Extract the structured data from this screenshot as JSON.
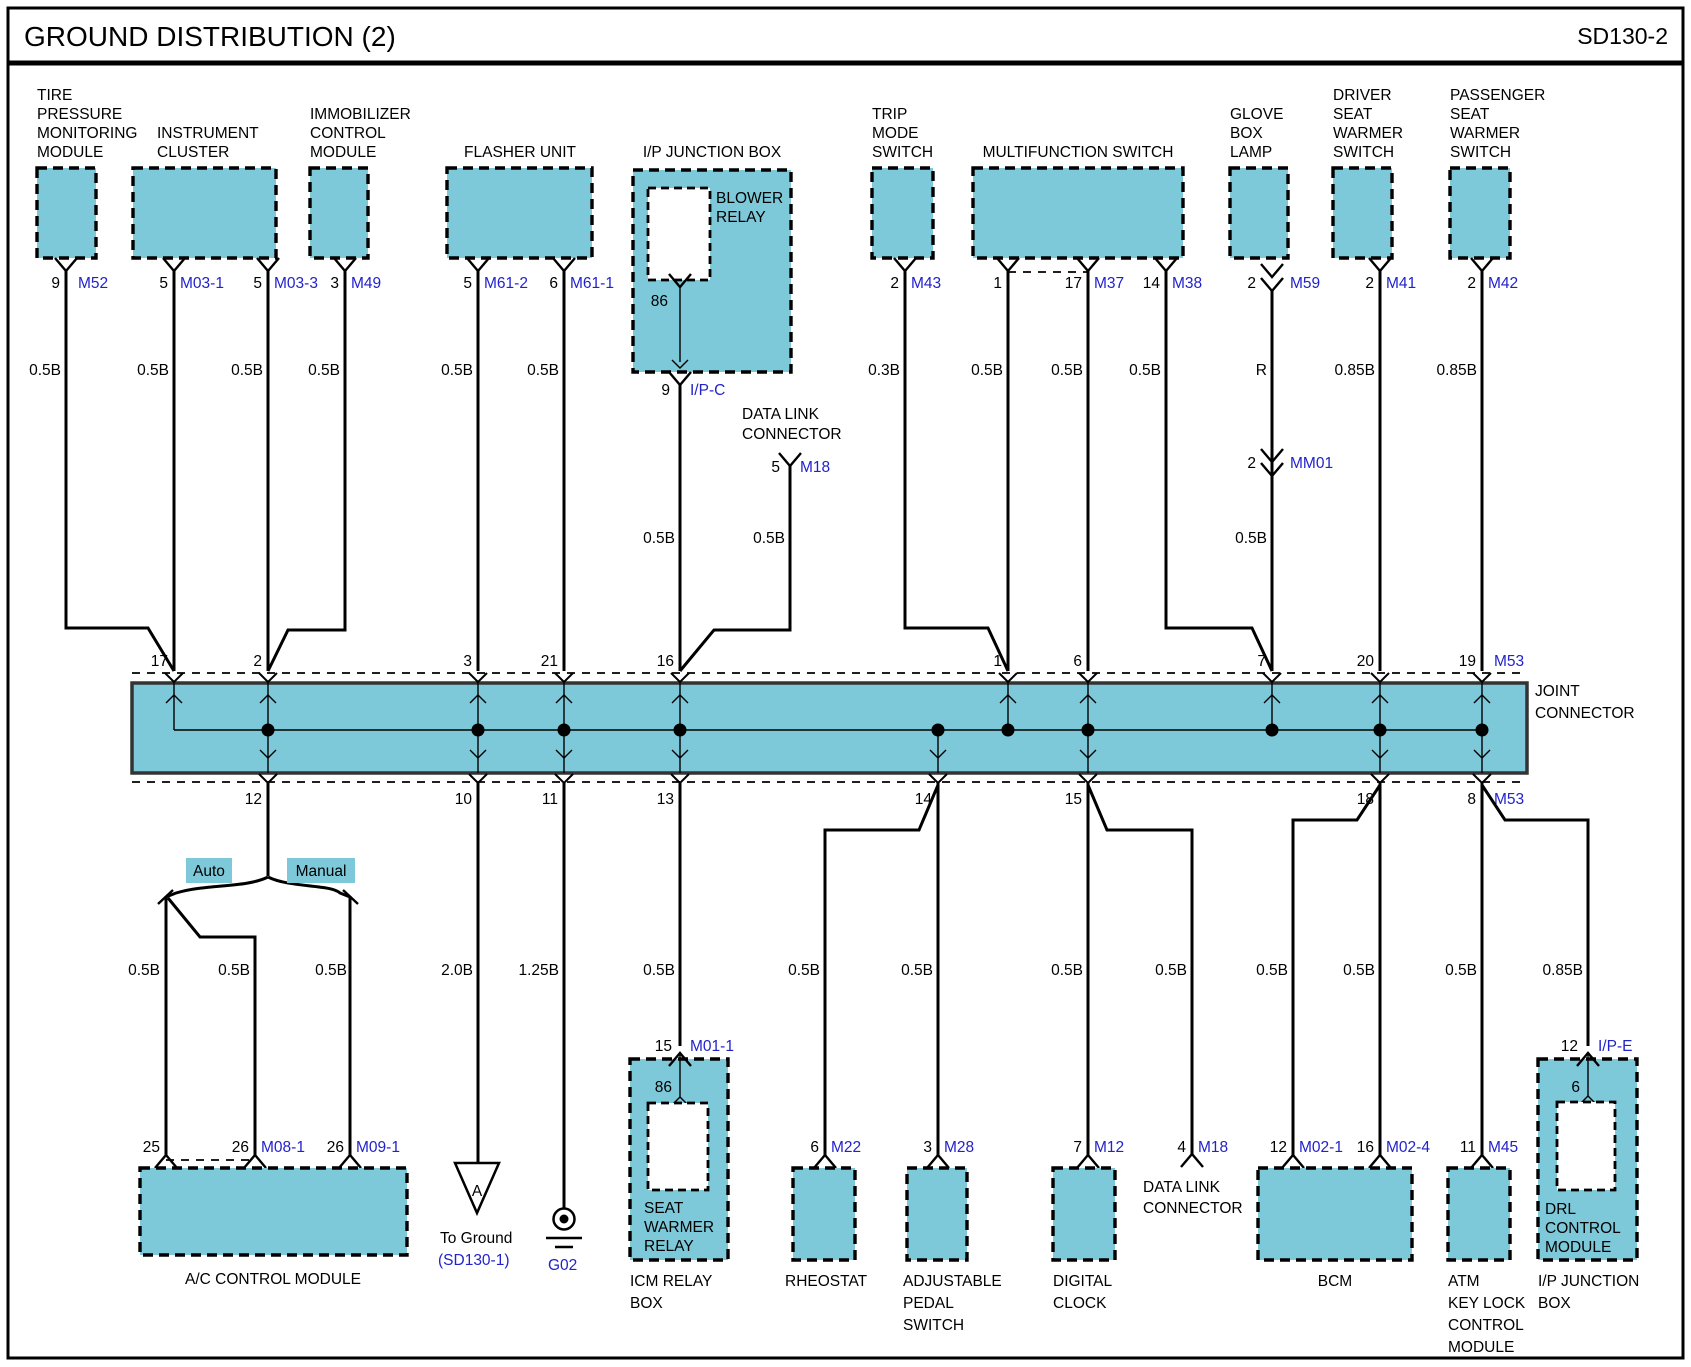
{
  "header": {
    "title": "GROUND DISTRIBUTION (2)",
    "code": "SD130-2"
  },
  "colors": {
    "module_fill": "#7ec9d9",
    "connector_text": "#2222cc",
    "wire": "#000000"
  },
  "top_row": {
    "tpms": {
      "name": [
        "TIRE",
        "PRESSURE",
        "MONITORING",
        "MODULE"
      ],
      "pin": "9",
      "connector": "M52",
      "wire": "0.5B"
    },
    "cluster": {
      "name": [
        "INSTRUMENT",
        "CLUSTER"
      ],
      "pins": [
        "5",
        "5"
      ],
      "connectors": [
        "M03-1",
        "M03-3"
      ],
      "wires": [
        "0.5B",
        "0.5B"
      ]
    },
    "immobilizer": {
      "name": [
        "IMMOBILIZER",
        "CONTROL",
        "MODULE"
      ],
      "pin": "3",
      "connector": "M49",
      "wire": "0.5B"
    },
    "flasher": {
      "name": "FLASHER UNIT",
      "pins": [
        "5",
        "6"
      ],
      "connectors": [
        "M61-2",
        "M61-1"
      ],
      "wires": [
        "0.5B",
        "0.5B"
      ]
    },
    "ip_junction": {
      "name": "I/P JUNCTION BOX",
      "relay": [
        "BLOWER",
        "RELAY"
      ],
      "relay_pin": "86",
      "pin": "9",
      "connector": "I/P-C",
      "wire": "0.5B"
    },
    "data_link": {
      "name": [
        "DATA LINK",
        "CONNECTOR"
      ],
      "pin": "5",
      "connector": "M18",
      "wire": "0.5B"
    },
    "trip": {
      "name": [
        "TRIP",
        "MODE",
        "SWITCH"
      ],
      "pin": "2",
      "connector": "M43",
      "wire": "0.3B"
    },
    "multifunction": {
      "name": "MULTIFUNCTION SWITCH",
      "pins": [
        "1",
        "17",
        "14"
      ],
      "connectors": [
        "M37",
        "M38"
      ],
      "wires": [
        "0.5B",
        "0.5B",
        "0.5B"
      ]
    },
    "glove": {
      "name": [
        "GLOVE",
        "BOX",
        "LAMP"
      ],
      "pin": "2",
      "connector": "M59",
      "wire1": "R",
      "pin2": "2",
      "connector2": "MM01",
      "wire2": "0.5B"
    },
    "driver_sws": {
      "name": [
        "DRIVER",
        "SEAT",
        "WARMER",
        "SWITCH"
      ],
      "pin": "2",
      "connector": "M41",
      "wire": "0.85B"
    },
    "passenger_sws": {
      "name": [
        "PASSENGER",
        "SEAT",
        "WARMER",
        "SWITCH"
      ],
      "pin": "2",
      "connector": "M42",
      "wire": "0.85B"
    }
  },
  "joint_connector": {
    "name": [
      "JOINT",
      "CONNECTOR"
    ],
    "top_pins": [
      "17",
      "2",
      "3",
      "21",
      "16",
      "1",
      "6",
      "7",
      "20",
      "19"
    ],
    "top_connector": "M53",
    "bottom_pins": [
      "12",
      "10",
      "11",
      "13",
      "14",
      "15",
      "18",
      "8"
    ],
    "bottom_connector": "M53"
  },
  "bottom_row": {
    "ac": {
      "name": "A/C CONTROL MODULE",
      "branch_auto": "Auto",
      "branch_manual": "Manual",
      "wires": [
        "0.5B",
        "0.5B",
        "0.5B"
      ],
      "pins": [
        "25",
        "26",
        "26"
      ],
      "connectors": [
        "M08-1",
        "M09-1"
      ]
    },
    "ground": {
      "wire": "2.0B",
      "symbol": "A",
      "text": "To Ground",
      "ref": "(SD130-1)"
    },
    "g02": {
      "wire": "1.25B",
      "name": "G02"
    },
    "icm": {
      "wire": "0.5B",
      "pin": "15",
      "connector": "M01-1",
      "relay_pin": "86",
      "relay": [
        "SEAT",
        "WARMER",
        "RELAY"
      ],
      "name": [
        "ICM RELAY",
        "BOX"
      ]
    },
    "rheostat": {
      "wire": "0.5B",
      "pin": "6",
      "connector": "M22",
      "name": "RHEOSTAT"
    },
    "pedal": {
      "wire": "0.5B",
      "pin": "3",
      "connector": "M28",
      "name": [
        "ADJUSTABLE",
        "PEDAL",
        "SWITCH"
      ]
    },
    "clock": {
      "wire": "0.5B",
      "pin": "7",
      "connector": "M12",
      "name": [
        "DIGITAL",
        "CLOCK"
      ]
    },
    "data_link": {
      "wire": "0.5B",
      "pin": "4",
      "connector": "M18",
      "name": [
        "DATA LINK",
        "CONNECTOR"
      ]
    },
    "bcm": {
      "wires": [
        "0.5B",
        "0.5B"
      ],
      "pins": [
        "12",
        "16"
      ],
      "connectors": [
        "M02-1",
        "M02-4"
      ],
      "name": "BCM"
    },
    "atm": {
      "wire": "0.5B",
      "pin": "11",
      "connector": "M45",
      "name": [
        "ATM",
        "KEY LOCK",
        "CONTROL",
        "MODULE"
      ]
    },
    "ip_junction": {
      "wire": "0.85B",
      "pin": "12",
      "connector": "I/P-E",
      "drl_pin": "6",
      "drl": [
        "DRL",
        "CONTROL",
        "MODULE"
      ],
      "name": [
        "I/P JUNCTION",
        "BOX"
      ]
    }
  }
}
